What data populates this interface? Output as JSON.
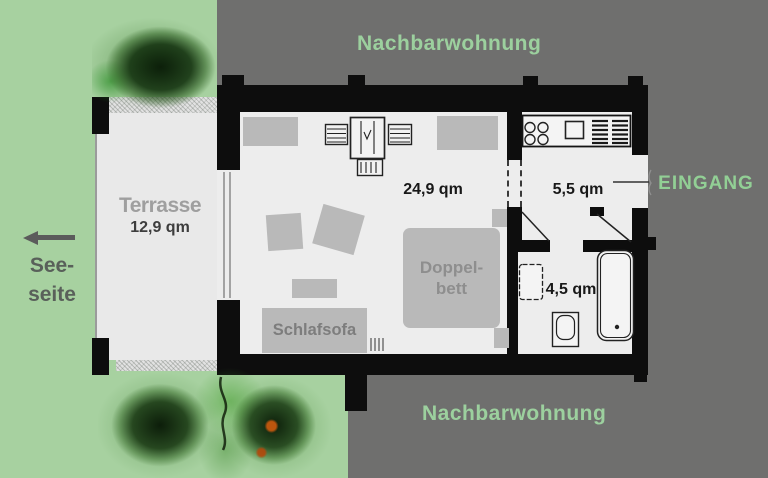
{
  "title": "Apartment floor plan",
  "labels": {
    "neighbor_top": "Nachbarwohnung",
    "neighbor_bottom": "Nachbarwohnung",
    "entrance": "EINGANG",
    "lake_side_line1": "See-",
    "lake_side_line2": "seite"
  },
  "rooms": {
    "terrace": {
      "name": "Terrasse",
      "area": "12,9 qm"
    },
    "living": {
      "area": "24,9 qm"
    },
    "kitchen": {
      "area": "5,5 qm"
    },
    "bathroom": {
      "area": "4,5 qm"
    }
  },
  "furniture": {
    "double_bed": {
      "line1": "Doppel-",
      "line2": "bett"
    },
    "sleep_sofa": {
      "label": "Schlafsofa"
    }
  },
  "icons": {
    "lake_direction": "arrow-left",
    "stove": "four-burner-stove",
    "kitchen_sink": "sink-square",
    "washbasin": "washbasin",
    "toilet": "toilet",
    "bathtub": "bathtub",
    "tv_unit": "tv-shelf-unit",
    "trees": "spray-tree"
  },
  "palette": {
    "background_green": "#a7d1a0",
    "background_gray": "#6f6f6e",
    "wall_black": "#0d0d0d",
    "floor_white": "#ededed",
    "furniture_gray": "#b9b9b9",
    "label_green": "#9cd09e",
    "entrance_green": "#92cf95",
    "dark_text": "#181818",
    "tree_green": "#1e4a14",
    "fruit_orange": "#c4580e"
  }
}
